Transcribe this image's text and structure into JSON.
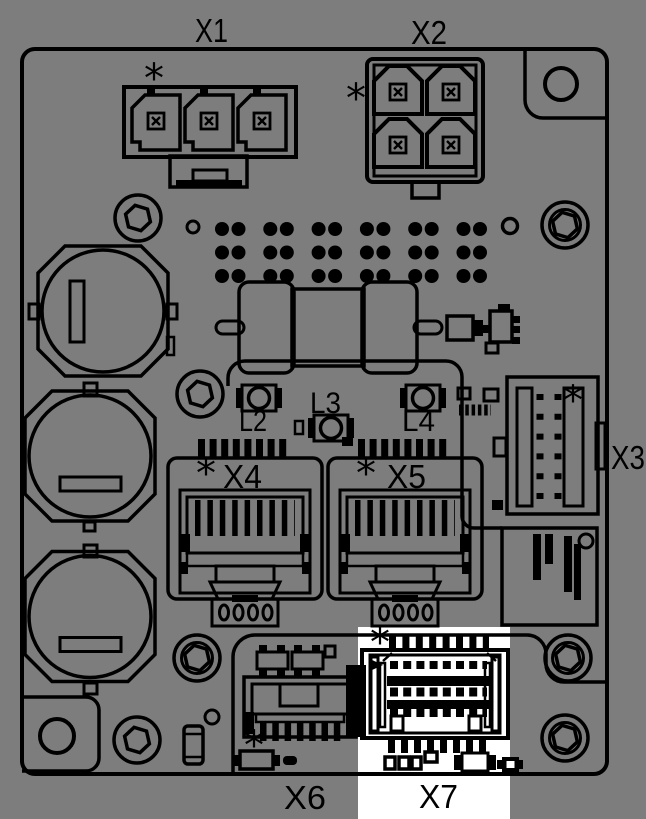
{
  "colors": {
    "background": "#7d7d7d",
    "line": "#000000",
    "highlight": "#ffffff"
  },
  "board": {
    "connector_labels": {
      "x1": "X1",
      "x2": "X2",
      "x3": "X3",
      "x4": "X4",
      "x5": "X5",
      "x6": "X6",
      "x7": "X7"
    },
    "led_labels": {
      "l2": "L2",
      "l3": "L3",
      "l4": "L4"
    },
    "pin1_marker": "*",
    "highlighted_connector": "X7"
  }
}
